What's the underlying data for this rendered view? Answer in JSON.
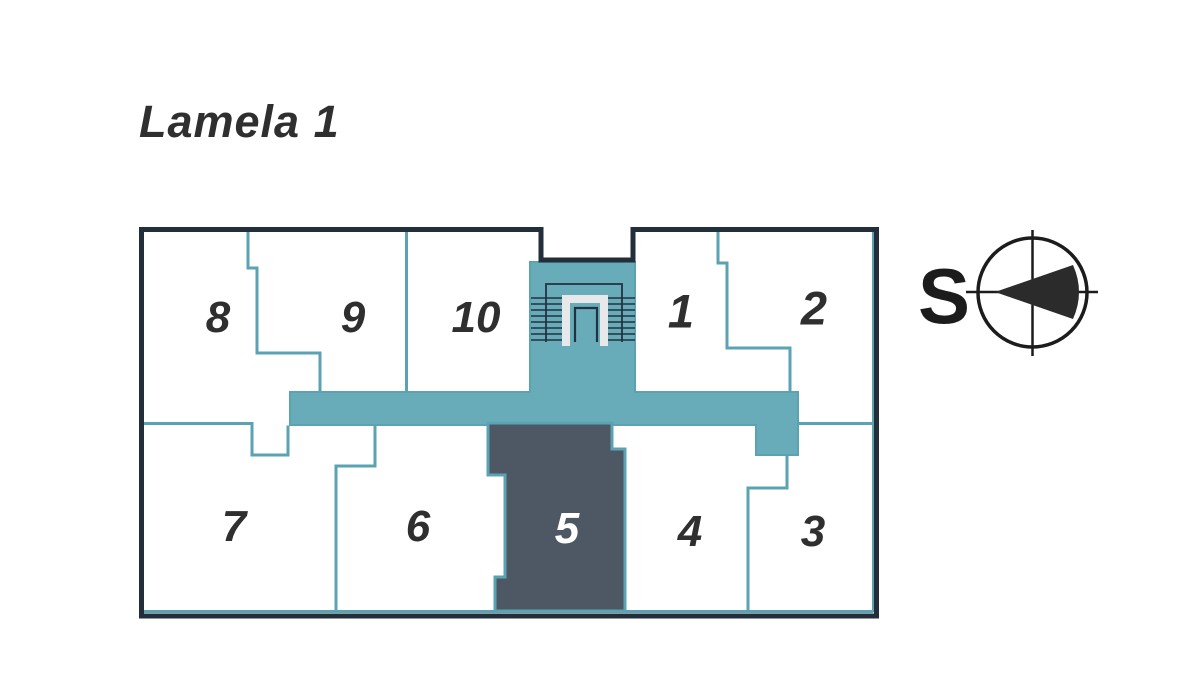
{
  "title": "Lamela 1",
  "compass": {
    "label": "S"
  },
  "plan": {
    "selected_unit": "5",
    "units": [
      {
        "number": "8"
      },
      {
        "number": "9"
      },
      {
        "number": "10"
      },
      {
        "number": "1"
      },
      {
        "number": "2"
      },
      {
        "number": "7"
      },
      {
        "number": "6"
      },
      {
        "number": "5"
      },
      {
        "number": "4"
      },
      {
        "number": "3"
      }
    ]
  },
  "icons": {
    "stairs": "stairs-icon",
    "compass": "compass-icon"
  },
  "colors": {
    "corridor_fill": "#69acb9",
    "wall_line": "#5ba3b2",
    "selected_unit_fill": "#4e5864",
    "outer_border": "#222f3a",
    "label_text": "#2f2f2f",
    "selected_label_text": "#ffffff",
    "compass_ink": "#2b2b2b",
    "stair_detail": "#233240",
    "stair_landing": "#e6e8ea"
  }
}
